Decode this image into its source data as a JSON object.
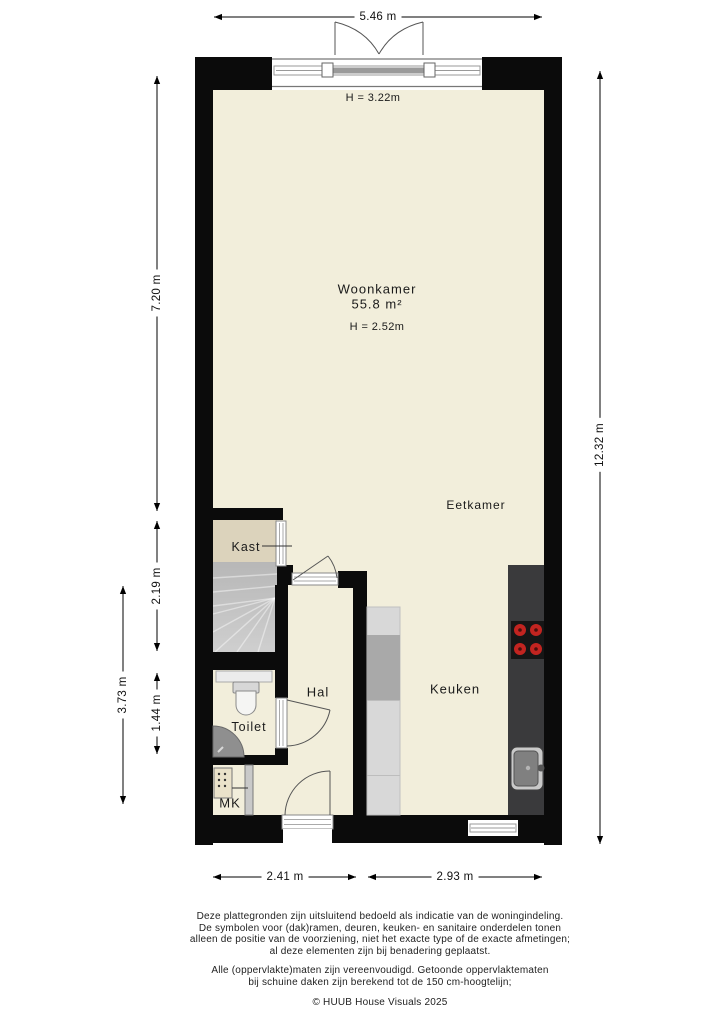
{
  "dimensions": {
    "top": "5.46 m",
    "right": "12.32 m",
    "left_living": "7.20 m",
    "left_stairs": "2.19 m",
    "left_toilet": "1.44 m",
    "left_outer": "3.73 m",
    "bottom_left": "2.41 m",
    "bottom_right": "2.93 m"
  },
  "rooms": {
    "woonkamer": {
      "label": "Woonkamer",
      "area": "55.8 m²",
      "height_front": "H = 3.22m",
      "height_rear": "H = 2.52m"
    },
    "eetkamer": {
      "label": "Eetkamer"
    },
    "keuken": {
      "label": "Keuken"
    },
    "hal": {
      "label": "Hal"
    },
    "toilet": {
      "label": "Toilet"
    },
    "kast": {
      "label": "Kast"
    },
    "meterkast": {
      "label": "MK"
    }
  },
  "footer": {
    "disclaimer1": [
      "Deze plattegronden zijn uitsluitend bedoeld als indicatie van de woningindeling.",
      "De symbolen voor (dak)ramen, deuren, keuken- en sanitaire onderdelen tonen",
      "alleen de positie van de voorziening, niet het exacte type of de exacte afmetingen;",
      "al deze elementen zijn bij benadering geplaatst."
    ],
    "disclaimer2": [
      "Alle (oppervlakte)maten zijn vereenvoudigd. Getoonde oppervlaktematen",
      "bij schuine daken zijn berekend tot de 150 cm-hoogtelijn;"
    ],
    "copyright": "© HUUB House Visuals 2025"
  },
  "colors": {
    "wall": "#0b0b0b",
    "floor": "#f2eedb",
    "closet_floor": "#dcd3bc",
    "stairs": "#c3c3c3",
    "counter_dark": "#3a3a3c",
    "cooktop": "#161616",
    "burner_red": "#c22420",
    "cabinet_light": "#d8d8d8",
    "cabinet_dark": "#a9a9a9"
  }
}
